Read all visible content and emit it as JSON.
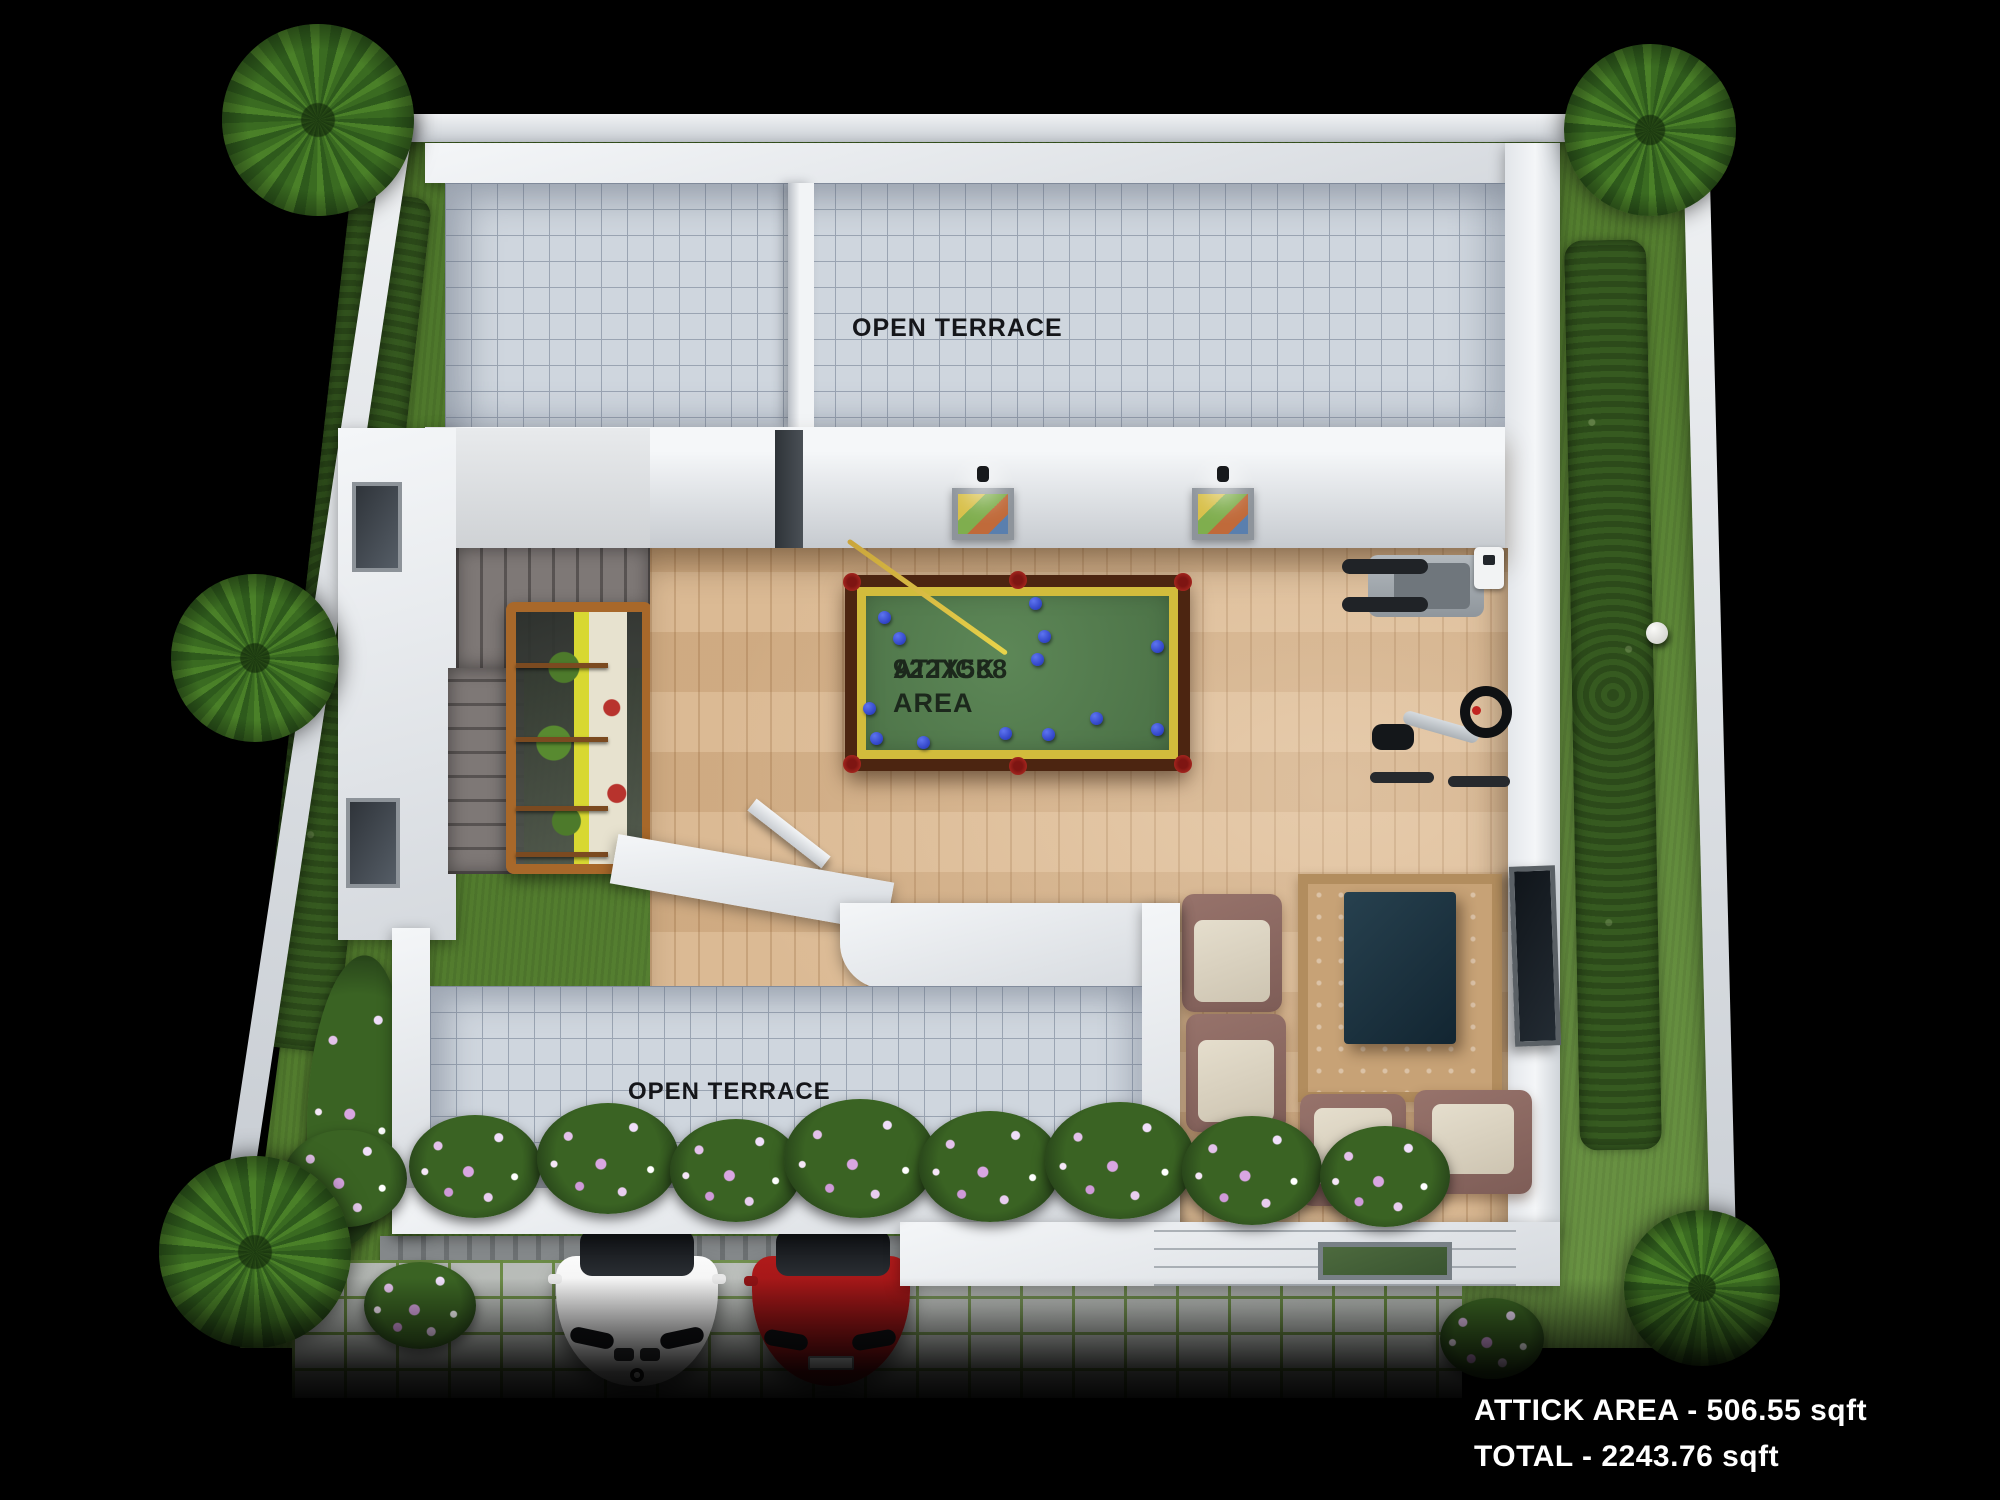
{
  "scene": {
    "type": "3d-floor-plan-render",
    "floor": "attic-terrace-level",
    "background_color": "#000000"
  },
  "labels": {
    "open_terrace_top": "OPEN TERRACE",
    "open_terrace_bottom": "OPEN TERRACE",
    "attick_area_title": "ATTICK AREA",
    "attick_area_dimensions": "922X588",
    "summary_line1": "ATTICK AREA - 506.55 sqft",
    "summary_line2": "TOTAL - 2243.76 sqft"
  },
  "rooms": [
    {
      "name": "open-terrace-top",
      "floor_finish": "tile-grid"
    },
    {
      "name": "attick-games-room",
      "floor_finish": "wood-plank"
    },
    {
      "name": "stairwell-with-atrium",
      "floor_finish": "concrete-steps"
    },
    {
      "name": "open-terrace-bottom",
      "floor_finish": "tile-grid"
    },
    {
      "name": "lounge-seating",
      "floor_finish": "wood-plank"
    },
    {
      "name": "entrance-porch",
      "floor_finish": "white-steps"
    },
    {
      "name": "driveway",
      "floor_finish": "concrete-pavers"
    }
  ],
  "objects": {
    "pool_table": {
      "felt_color": "#4a7045",
      "rail_color": "#d2bc3c",
      "frame_color": "#4c2511",
      "ball_color": "#1d2fb4",
      "pocket_color": "#c23227",
      "balls": [
        [
          21,
          24
        ],
        [
          36,
          45
        ],
        [
          172,
          10
        ],
        [
          181,
          43
        ],
        [
          174,
          66
        ],
        [
          294,
          53
        ],
        [
          6,
          115
        ],
        [
          233,
          125
        ],
        [
          294,
          136
        ],
        [
          142,
          140
        ],
        [
          185,
          141
        ],
        [
          13,
          145
        ],
        [
          60,
          149
        ]
      ]
    },
    "gym": [
      "treadmill",
      "exercise-bike"
    ],
    "lounge": {
      "armchairs": 4,
      "rug": 1,
      "coffee_table": 1,
      "tv": 1
    },
    "wall_art": {
      "pictures": 2,
      "spotlights": 2
    },
    "cars": [
      {
        "color": "#f2f2f2",
        "make_hint": "white-coupe"
      },
      {
        "color": "#a01418",
        "make_hint": "red-sedan"
      }
    ]
  },
  "garden": {
    "palm_trees": [
      {
        "x": 318,
        "y": 120,
        "r": 96
      },
      {
        "x": 1650,
        "y": 130,
        "r": 86
      },
      {
        "x": 255,
        "y": 658,
        "r": 84
      },
      {
        "x": 255,
        "y": 1252,
        "r": 96
      },
      {
        "x": 1702,
        "y": 1288,
        "r": 78
      }
    ],
    "flower_bushes": [
      [
        345,
        1178,
        124
      ],
      [
        475,
        1166,
        132
      ],
      [
        608,
        1158,
        142
      ],
      [
        736,
        1170,
        132
      ],
      [
        860,
        1158,
        152
      ],
      [
        990,
        1166,
        142
      ],
      [
        1120,
        1160,
        150
      ],
      [
        1252,
        1170,
        140
      ],
      [
        1385,
        1176,
        130
      ],
      [
        420,
        1305,
        112
      ],
      [
        1492,
        1338,
        104
      ]
    ],
    "grass_color": "#557f30",
    "hedge_color": "#2c4a1a",
    "flower_colors": [
      "#d9a6e2",
      "#f0defa",
      "#ffffff"
    ]
  },
  "colors": {
    "boundary_wall": "#e6e9ec",
    "building_wall": "#eef0f3",
    "terrace_tile": "#cfd6de",
    "tile_grout": "#9aa4b2",
    "wood_floor": "#d9b68e",
    "stair_concrete": "#7e7876",
    "atrium_frame": "#a8682a",
    "sofa_frame": "#8a665e",
    "sofa_cushion": "#d9d2c0",
    "coffee_table": "#1b3340",
    "label_dark": "#15161a",
    "label_light": "#ffffff"
  }
}
